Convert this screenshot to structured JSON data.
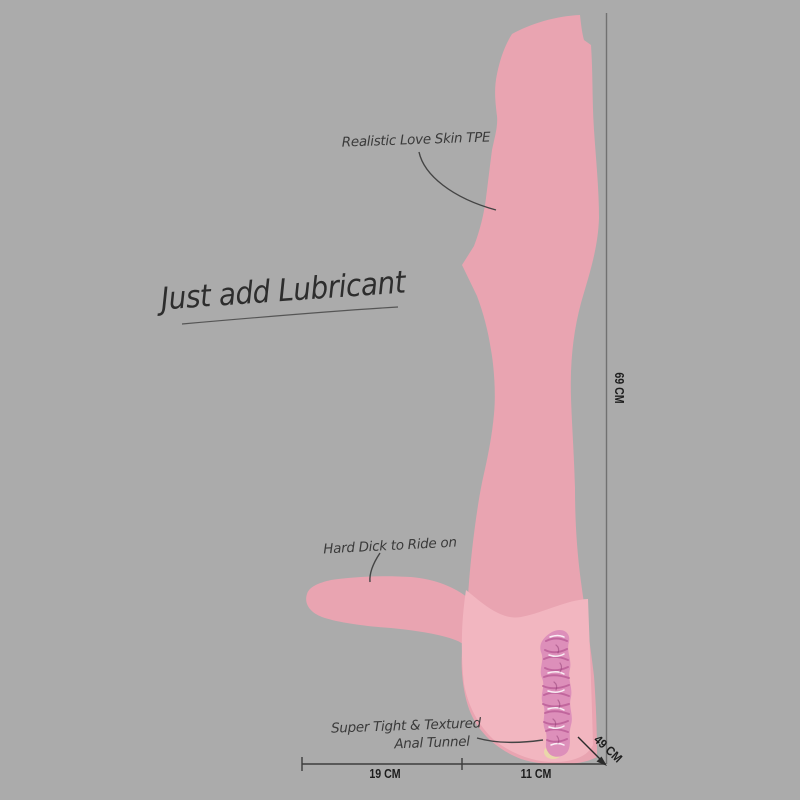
{
  "annotations": {
    "tagline": "Just add Lubricant",
    "material": "Realistic Love Skin TPE",
    "ride_feature": "Hard Dick to Ride on",
    "tunnel_feature_line1": "Super Tight & Textured",
    "tunnel_feature_line2": "Anal Tunnel"
  },
  "dimensions": {
    "height": "69 CM",
    "depth": "49 CM",
    "bottom_left_width": "19 CM",
    "bottom_right_width": "11 CM"
  },
  "colors": {
    "background": "#ababab",
    "skin_pink": "#e9a4b1",
    "interior_pink": "#f2b6c0",
    "tunnel_pink": "#dd8fba",
    "tunnel_rib": "#bb5d97",
    "ink": "#3a3a3a",
    "dimension_ink": "#1d1d1d"
  }
}
